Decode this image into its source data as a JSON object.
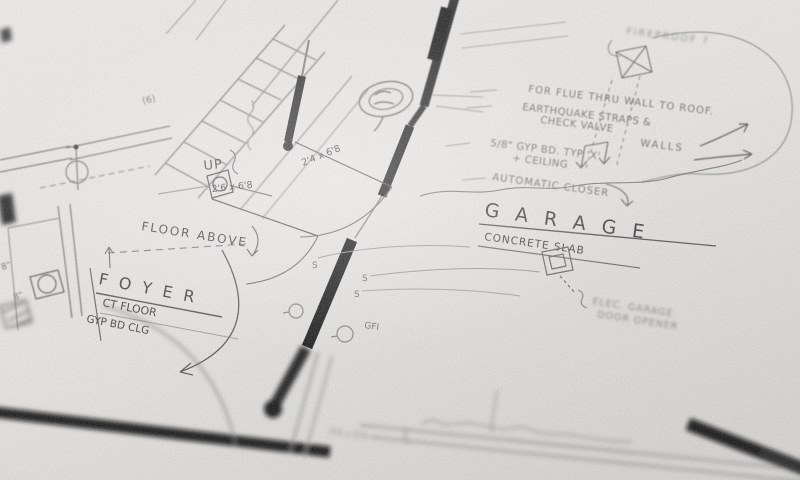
{
  "scene": "photograph of a hand-sketched architectural floor plan, pencil on white paper, shallow depth of field",
  "colors": {
    "paper": "#e9e8e6",
    "pencil": "#4a4a4a",
    "wall_poche": "#111111"
  },
  "rooms": {
    "foyer": {
      "title": "F O Y E R",
      "floor": "CT FLOOR",
      "ceiling": "GYP BD CLG"
    },
    "garage": {
      "title": "G A R A G E",
      "floor": "CONCRETE SLAB"
    }
  },
  "stairs": {
    "up": "UP",
    "count": "(6)"
  },
  "doors": {
    "d1": "2'4 x 6'8",
    "d2": "2'6 x 6'8",
    "d3": "3'0 x 6'8"
  },
  "electrical": {
    "gfi": "GFI",
    "switch": "S"
  },
  "dimensions": {
    "wall": "8\""
  },
  "annotations": {
    "floor_above": "FLOOR ABOVE",
    "fireproof": "FIREPROOF ?",
    "flue": "FOR FLUE THRU WALL TO ROOF.",
    "quake1": "EARTHQUAKE STRAPS &",
    "quake2": "CHECK VALVE",
    "gyp1": "5/8\" GYP BD. TYP 'X'",
    "gyp_walls": "WALLS",
    "gyp2": "+ CEILING",
    "closer": "AUTOMATIC CLOSER",
    "opener1": "ELEC. GARAGE",
    "opener2": "DOOR OPENER"
  }
}
